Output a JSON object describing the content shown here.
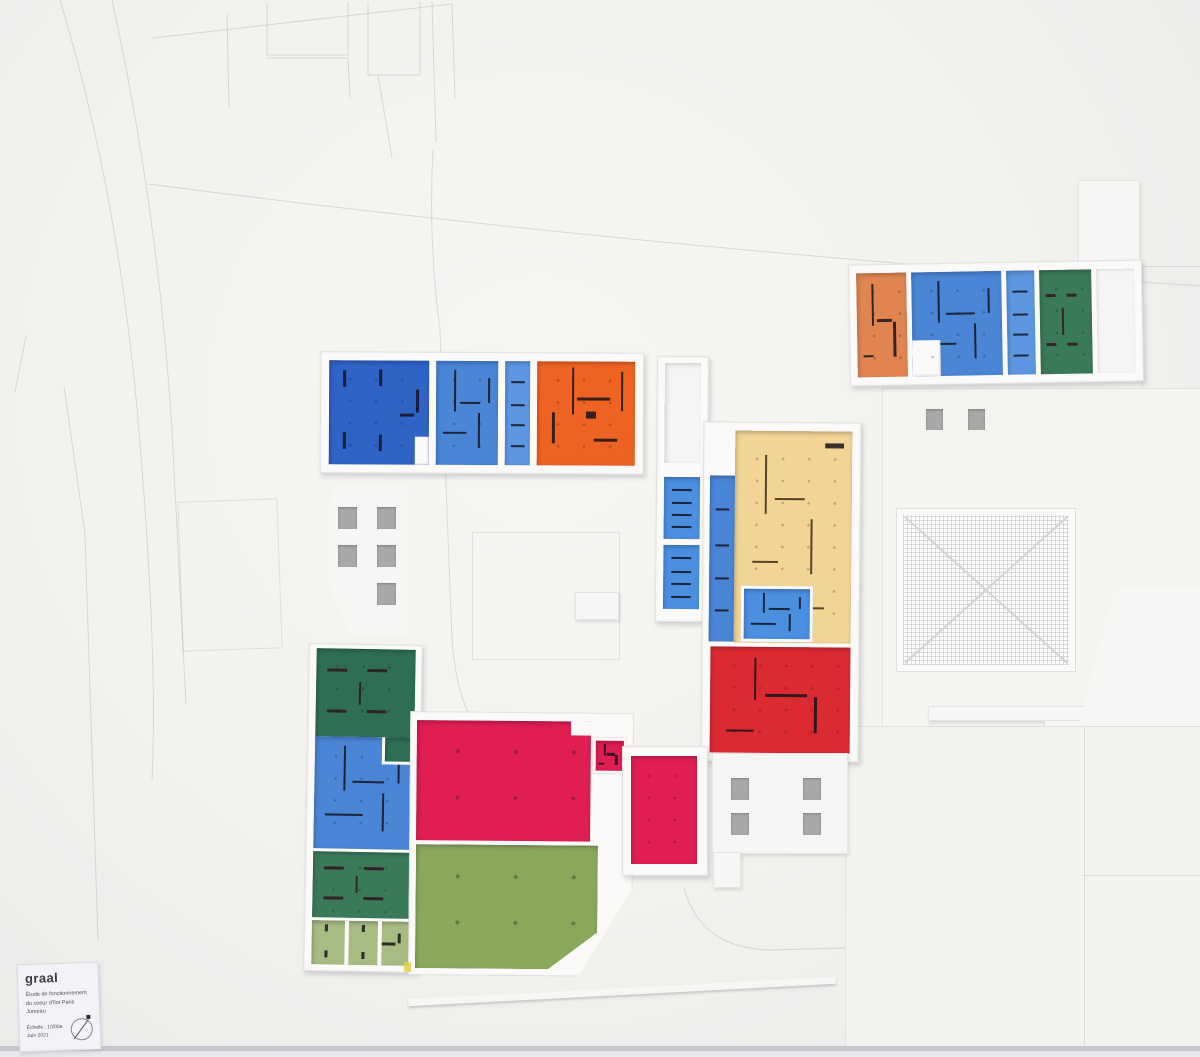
{
  "label_card": {
    "title": "graal",
    "subtitle_line1": "Étude de fonctionnement",
    "subtitle_line2": "du coeur d'îlot Paris Jumeau",
    "scale": "Échelle : 1/200e",
    "date": "Juin 2021"
  },
  "palette": {
    "blue_dark": "#2f63c6",
    "blue_mid": "#4a85d6",
    "blue_light": "#5d97e2",
    "blue_cell": "#4a8fe0",
    "orange": "#ee6322",
    "orange_salmon": "#e08550",
    "green_dark": "#2f6e54",
    "green_forest": "#3a7a58",
    "green_olive": "#8aa85c",
    "green_sage": "#a7bc82",
    "beige": "#f2d494",
    "red": "#dc2a32",
    "crimson": "#e01e52",
    "white_unit": "#f6f5f3",
    "window_gray": "#a8a8a8",
    "stain_yellow": "#e4cf4e"
  }
}
